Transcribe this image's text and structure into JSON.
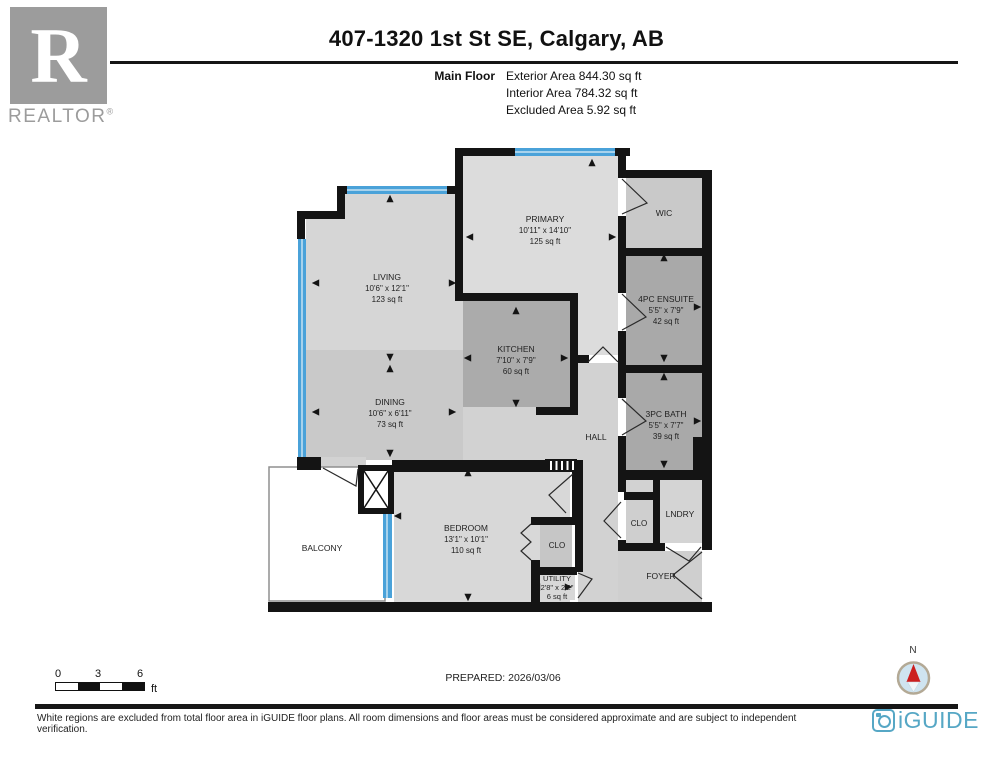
{
  "header": {
    "title": "407-1320 1st St SE, Calgary, AB",
    "floor_label": "Main Floor",
    "exterior": "Exterior Area 844.30 sq ft",
    "interior": "Interior Area 784.32 sq ft",
    "excluded": "Excluded Area 5.92 sq ft"
  },
  "realtor": {
    "monogram": "R",
    "wordmark": "REALTOR",
    "registered": "®"
  },
  "rooms": {
    "living": {
      "name": "LIVING",
      "dims": "10'6\" x 12'1\"",
      "area": "123 sq ft"
    },
    "dining": {
      "name": "DINING",
      "dims": "10'6\" x 6'11\"",
      "area": "73 sq ft"
    },
    "kitchen": {
      "name": "KITCHEN",
      "dims": "7'10\" x 7'9\"",
      "area": "60 sq ft"
    },
    "primary": {
      "name": "PRIMARY",
      "dims": "10'11\" x 14'10\"",
      "area": "125 sq ft"
    },
    "wic": {
      "name": "WIC"
    },
    "ensuite": {
      "name": "4PC ENSUITE",
      "dims": "5'5\" x 7'9\"",
      "area": "42 sq ft"
    },
    "bath": {
      "name": "3PC BATH",
      "dims": "5'5\" x 7'7\"",
      "area": "39 sq ft"
    },
    "hall": {
      "name": "HALL"
    },
    "bedroom": {
      "name": "BEDROOM",
      "dims": "13'1\" x 10'1\"",
      "area": "110 sq ft"
    },
    "clo_bedroom": {
      "name": "CLO"
    },
    "utility": {
      "name": "UTILITY",
      "dims": "2'8\" x 2'2\"",
      "area": "6 sq ft"
    },
    "clo_hall": {
      "name": "CLO"
    },
    "lndry": {
      "name": "LNDRY"
    },
    "foyer": {
      "name": "FOYER"
    },
    "balcony": {
      "name": "BALCONY"
    }
  },
  "scale_bar": {
    "t0": "0",
    "t3": "3",
    "t6": "6",
    "unit": "ft"
  },
  "prepared": "PREPARED: 2026/03/06",
  "compass": {
    "north": "N"
  },
  "footer": {
    "disclaimer": "White regions are excluded from total floor area in iGUIDE floor plans. All room dimensions and floor areas must be considered approximate and are subject to independent verification.",
    "brand": "iGUIDE"
  },
  "colors": {
    "wall": "#141414",
    "window": "#4aa2d9",
    "brand": "#56a7c5",
    "needle": "#cc1f1f"
  }
}
